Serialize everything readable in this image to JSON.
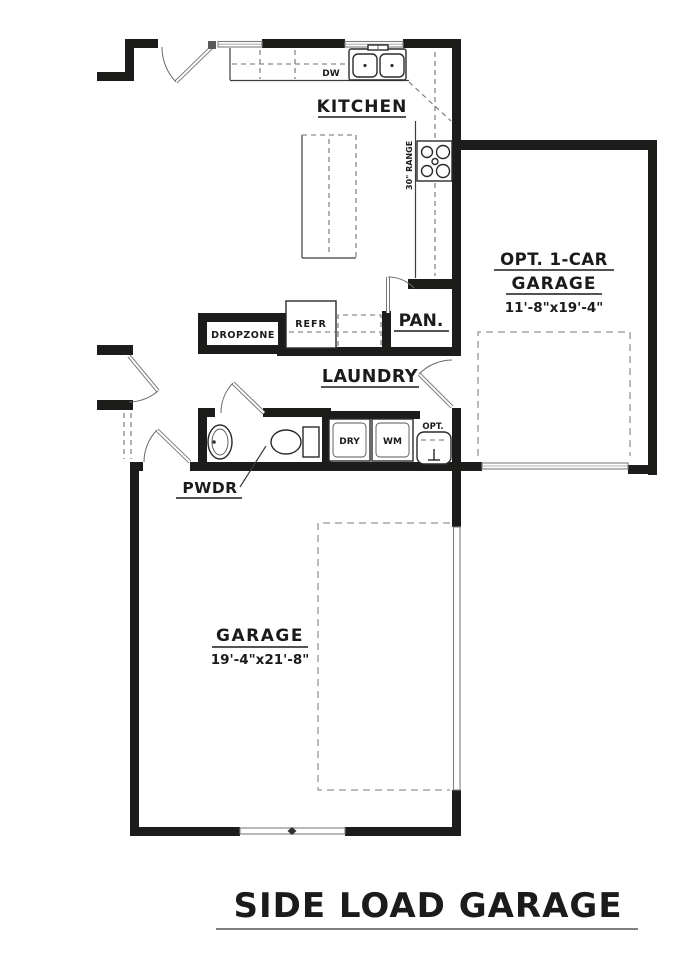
{
  "plan": {
    "title": "SIDE LOAD GARAGE",
    "kitchen": {
      "label": "KITCHEN",
      "dishwasher": "DW",
      "range": "30\" RANGE",
      "refrigerator": "REFR"
    },
    "pantry": {
      "label": "PAN."
    },
    "dropzone": {
      "label": "DROPZONE"
    },
    "laundry": {
      "label": "LAUNDRY",
      "dryer": "DRY",
      "washer": "WM",
      "utility_sink": "OPT."
    },
    "powder": {
      "label": "PWDR"
    },
    "opt_garage": {
      "label1": "OPT. 1-CAR",
      "label2": "GARAGE",
      "dims": "11'-8\"x19'-4\""
    },
    "garage": {
      "label": "GARAGE",
      "dims": "19'-4\"x21'-8\""
    },
    "colors": {
      "wall": "#1c1c1a",
      "thin_line": "#3d3d3d",
      "dashed_line": "#949494",
      "background": "#ffffff"
    }
  }
}
